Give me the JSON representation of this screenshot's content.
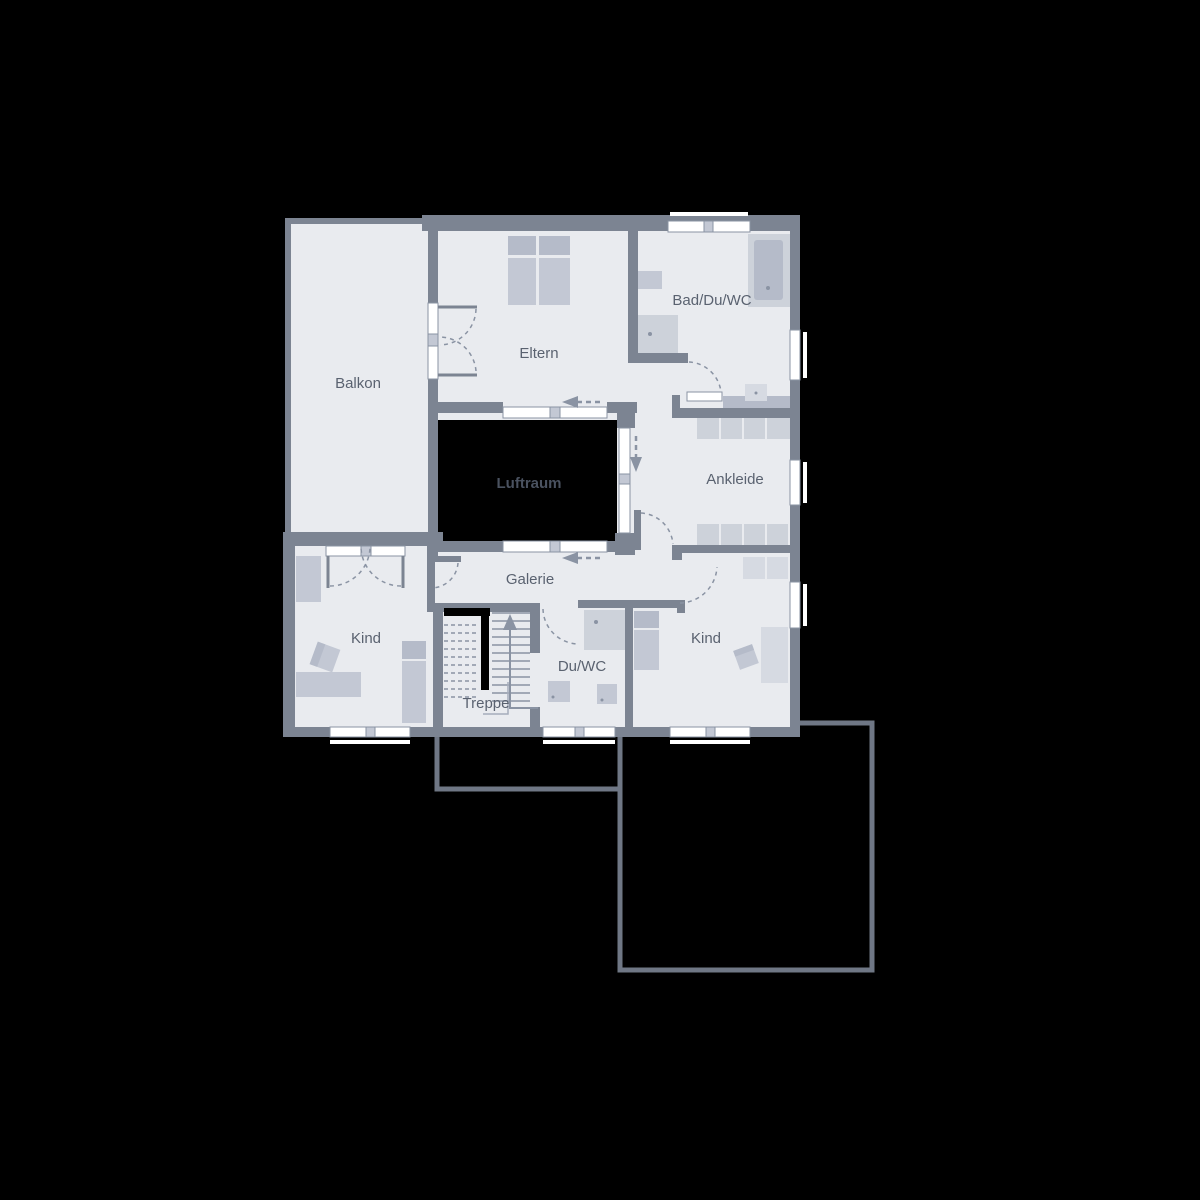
{
  "floor_plan": {
    "labels": {
      "balkon": "Balkon",
      "eltern": "Eltern",
      "bad_du_wc": "Bad/Du/WC",
      "ankleide": "Ankleide",
      "luftraum": "Luftraum",
      "galerie": "Galerie",
      "kind_left": "Kind",
      "treppe": "Treppe",
      "du_wc": "Du/WC",
      "kind_right": "Kind"
    },
    "colors": {
      "background": "#000000",
      "wall": "#7c8492",
      "floor": "#e9ebef",
      "furniture": "#c3c8d4",
      "furniture_dark": "#b5bbc9",
      "furniture_light": "#d6dae2",
      "void_fill": "#000000",
      "label_text": "#5a6270",
      "luftraum_text": "#4a5260",
      "arrow": "#8a93a3",
      "window": "#ffffff",
      "lower_floor_outline": "#6f7785"
    }
  }
}
